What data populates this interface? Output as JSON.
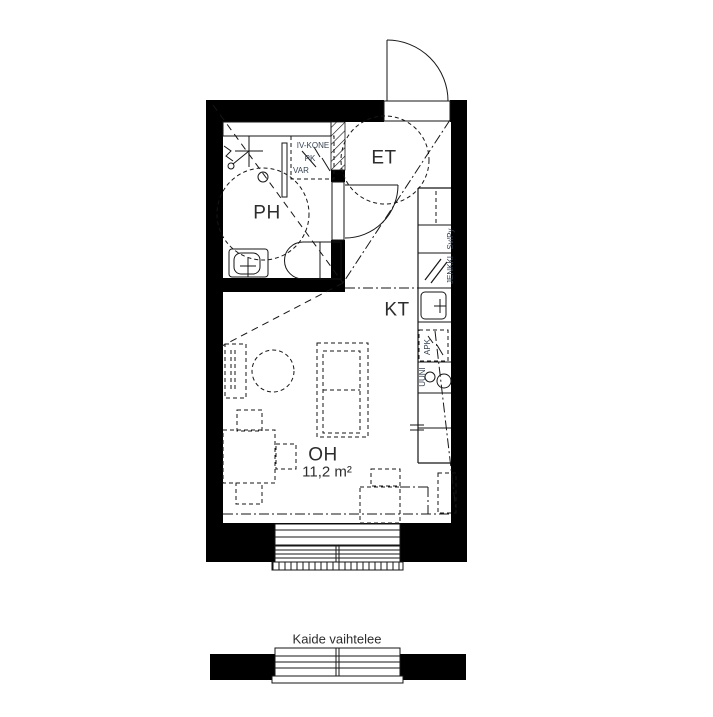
{
  "colors": {
    "wall": "#000000",
    "line": "#161616",
    "text_dark": "#2d2d2d",
    "text_small": "#374251",
    "bg": "#ffffff"
  },
  "rooms": {
    "ph": "PH",
    "et": "ET",
    "kt": "KT",
    "oh": "OH",
    "oh_area": "11,2 m²"
  },
  "closet": {
    "line1": "IV-KONE",
    "line2": "PK",
    "line3": "VAR"
  },
  "kitchen": {
    "sv_py": "Sv/Py",
    "jenkki": "JENKKI",
    "apk": "APK",
    "uuni": "UUNI"
  },
  "balcony": {
    "note": "Kaide vaihtelee"
  }
}
